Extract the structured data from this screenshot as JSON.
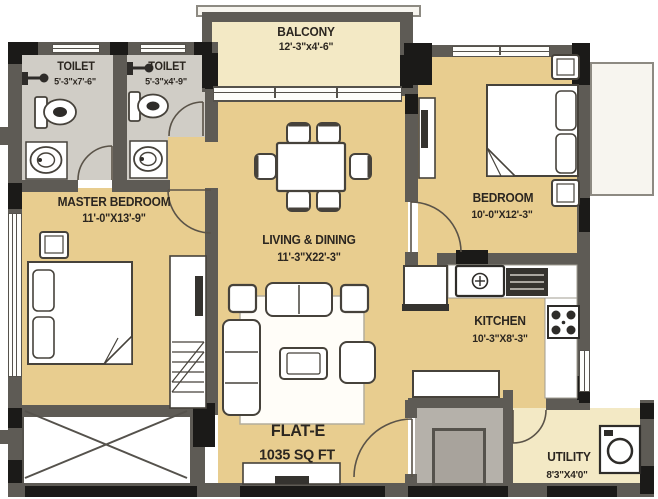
{
  "plan": {
    "flat": {
      "name": "FLAT-E",
      "area": "1035 SQ FT"
    },
    "rooms": [
      {
        "id": "balcony",
        "name": "BALCONY",
        "dims": "12'-3\"x4'-6\""
      },
      {
        "id": "toilet-1",
        "name": "TOILET",
        "dims": "5'-3\"x7'-6\""
      },
      {
        "id": "toilet-2",
        "name": "TOILET",
        "dims": "5'-3\"x4'-9\""
      },
      {
        "id": "master-bedroom",
        "name": "MASTER BEDROOM",
        "dims": "11'-0\"X13'-9\""
      },
      {
        "id": "living-dining",
        "name": "LIVING & DINING",
        "dims": "11'-3\"X22'-3\""
      },
      {
        "id": "bedroom",
        "name": "BEDROOM",
        "dims": "10'-0\"X12'-3\""
      },
      {
        "id": "kitchen",
        "name": "KITCHEN",
        "dims": "10'-3\"X8'-3\""
      },
      {
        "id": "utility",
        "name": "UTILITY",
        "dims": "8'3\"X4'0\""
      }
    ],
    "colors": {
      "room_fill": "#e8cd8f",
      "balcony_utility_fill": "#f3e9c5",
      "toilet_fill": "#d0cdc6",
      "wall": "#5e5b55",
      "wall_accent": "#1b1a18",
      "foyer_fill": "#b5b1aa",
      "furniture_stroke": "#46423b",
      "text": "#2b2620"
    }
  }
}
